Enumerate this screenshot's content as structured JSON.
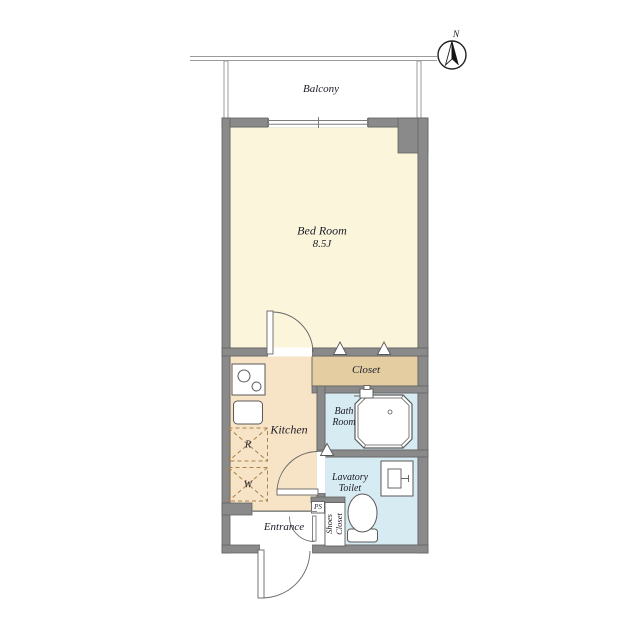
{
  "colors": {
    "wall": "#8a8a8a",
    "wall_edge": "#616161",
    "bedroom": "#FBF5DB",
    "kitchen": "#F7E3C5",
    "closet": "#E4CEA1",
    "bath": "#D7EBF2",
    "lavatory": "#D7EBF2",
    "appliance_dash": "#A9824E",
    "thin_line": "#5a5a5a"
  },
  "compass": {
    "label": "N"
  },
  "balcony": {
    "label": "Balcony"
  },
  "bedroom": {
    "label": "Bed Room",
    "size": "8.5J"
  },
  "closet": {
    "label": "Closet"
  },
  "kitchen": {
    "label": "Kitchen",
    "refrigerator": "R",
    "washer": "W"
  },
  "bath": {
    "line1": "Bath",
    "line2": "Room"
  },
  "lavatory": {
    "line1": "Lavatory",
    "line2": "Toilet"
  },
  "entrance": {
    "label": "Entrance"
  },
  "shoes_closet": {
    "line1": "Shoes",
    "line2": "Closet"
  },
  "pipe_space": {
    "label": "PS"
  }
}
